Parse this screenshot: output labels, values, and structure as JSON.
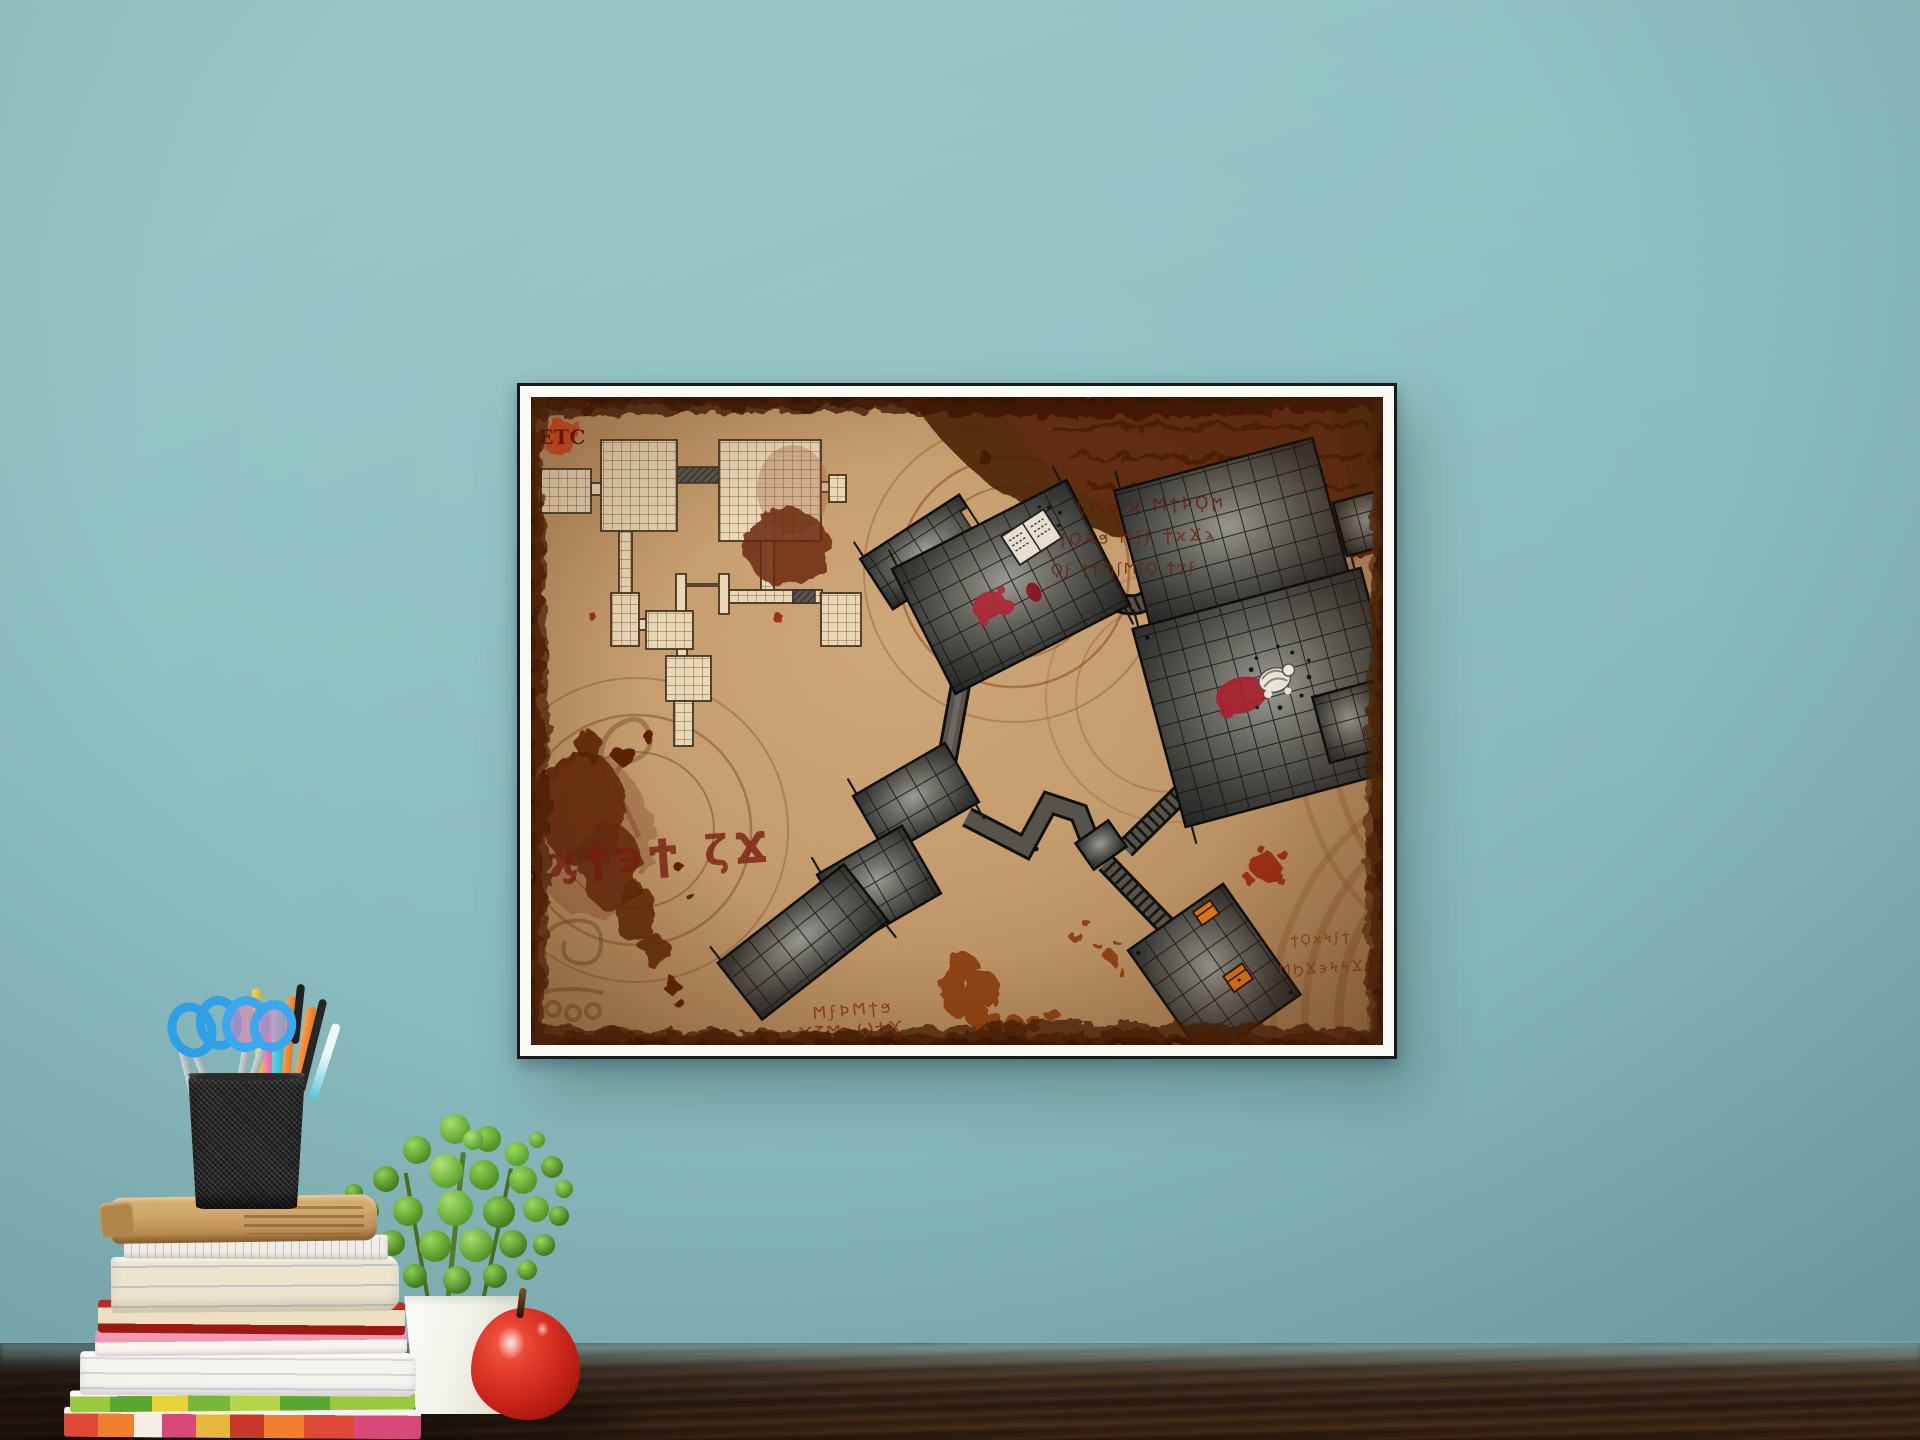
{
  "scene": {
    "type": "photograph",
    "description": "Framed fantasy dungeon battle-map printed on aged parchment, hanging on a teal wall above a dark wooden desk holding a stack of books, a black mesh pencil cup with scissors and colored pens, a green potted plant and a red apple",
    "wall_color": "#8ec0c3",
    "table_wood_color": "#2e1d12",
    "print_border_color": "#fbfaf5",
    "frame_outline_color": "#17191a"
  },
  "map": {
    "logo": {
      "text": "ETC",
      "badge_color": "#d2491e",
      "text_color": "#6e1206"
    },
    "parchment_color": "#c89f70",
    "burnt_edge_color": "#552408",
    "stain_color": "#5c2306",
    "sketch_dungeon": {
      "style": "unfinished pencil-grid rooms, top-left",
      "ink_color": "#47341f",
      "paper_color": "#e9d8b6"
    },
    "stone_dungeon": {
      "style": "finished dark stone rooms with tiled floors, connected by corridors and ribbed stairways",
      "stone_color": "#3f3f3c",
      "features": [
        "open book with blood stain",
        "skeleton with blood pool",
        "two orange treasure chests",
        "ribbed stairways"
      ]
    },
    "blood_color": "#b02838",
    "chest_color": "#e07818",
    "runes": {
      "top_right_1": "ϞϺ϶·ϗ ϺϯϷϘϻ",
      "top_right_2": "ʃϘϞϧ Ϻʃϝ ϮϰϪϡ",
      "top_right_3": "Ϙϝ ϮϯϠʃϺʃϘ ϮϮϝ",
      "left_large": "ϗϯ϶Ϯ ζϪ",
      "bottom_center_1": "ϺϝϷϺϯϧ",
      "bottom_center_2": "ϪζϺϡϢϮϪ",
      "bottom_right_1": "ϮϘϰϞϝϮ",
      "bottom_right_2": "ϺϦϪ϶ϞϟϪϧ"
    }
  },
  "desk": {
    "items": [
      "stack of books and notebooks",
      "black mesh pencil cup",
      "two blue scissors",
      "colored pencils and pens",
      "green plant in white square pot",
      "red apple"
    ],
    "book_colors": [
      "#c9a368",
      "#f0ede4",
      "#ece4cd",
      "#b5261e",
      "#ef9ab5",
      "#f5f3ee",
      "#9ac83e",
      "#e04838"
    ],
    "scissors_color": "#35a3e8",
    "plant_color": "#5aa32c",
    "pot_color": "#f4f4f0",
    "apple_color": "#c62318"
  }
}
